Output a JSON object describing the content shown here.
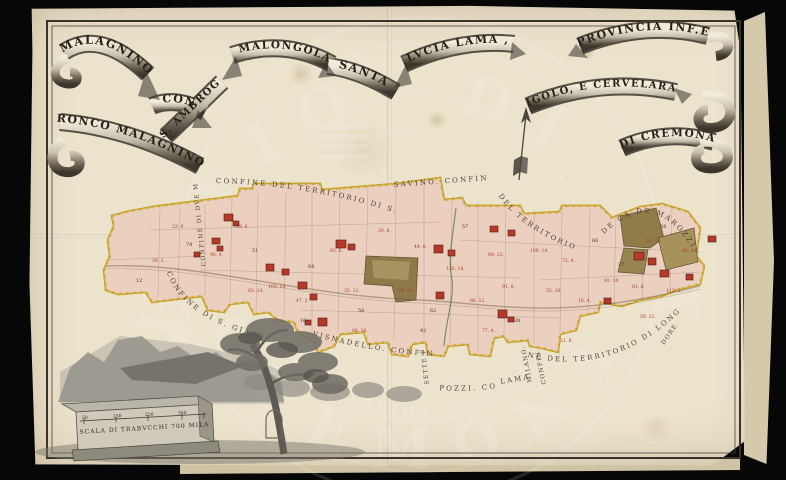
{
  "watermark": {
    "outer_top": "ARCHIVIO DI STATO",
    "outer_bottom": "CREMONA",
    "inner_ring": "REPUBBLICA ITALIANA"
  },
  "ribbon": {
    "segments": [
      "MALAGNINO",
      "CON",
      "RONCO MALAGNINO",
      "S. AMBROG.",
      ", MALONGOLA,",
      "SANTA",
      "LVCIA LAMA ,",
      "IGOLO, E CERVELARA",
      "PROVINCIA INF.E",
      "DI CREMONA"
    ]
  },
  "map_labels": {
    "confine_top_left": "CONFINE DEL TERRITORIO DI S.",
    "confine_top_mid": "SAVINO. CONFINE",
    "confine_top_right_a": "DEL TERRITORIO",
    "confine_top_right_b": "DE CÀ DE MAROZZI",
    "confine_left_vertical": "CONFINE DI DVE MIGLIA",
    "confine_left_lower": "CONFINE DI S. GIACOMO. LOVARA.",
    "confine_bottom_a": "VISNADELLO. CONFINE DE",
    "confine_bottom_vertical": "SETTE P.",
    "confine_bottom_b": "POZZI. CONF.E",
    "confine_bottom_c": "LAMA.",
    "confine_right_vertical_a": "MILANO.",
    "confine_right_vertical_b": "CONFIN.",
    "confine_bottom_right": "NE DEL TERRITORIO DI LONGAR",
    "confine_bottom_right_end": "DORE",
    "direction_e": "E."
  },
  "scale": {
    "caption": "SCALA DI TRABVCCHI 700 MILAN.",
    "ticks": [
      "50",
      "150",
      "250",
      "350"
    ]
  },
  "colors": {
    "paper": "#ece3cd",
    "ink": "#3b332a",
    "territory_fill": "#ecd0bf",
    "territory_outline": "#caa42c",
    "building_red": "#b5382a",
    "wood_olive": "#8d7a4a",
    "annotation_red": "#a63a2e"
  },
  "parcel_labels": [
    [
      172,
      228,
      "23. 8.",
      "r"
    ],
    [
      186,
      246,
      "74",
      "k"
    ],
    [
      210,
      256,
      "96. 4.",
      "r"
    ],
    [
      236,
      228,
      "29. 6.",
      "r"
    ],
    [
      252,
      252,
      "51",
      "k"
    ],
    [
      268,
      288,
      "103. 14.",
      "r"
    ],
    [
      296,
      302,
      "47. 2.",
      "r"
    ],
    [
      308,
      268,
      "64",
      "k"
    ],
    [
      330,
      252,
      "83. 6.",
      "r"
    ],
    [
      344,
      292,
      "35. 12.",
      "r"
    ],
    [
      358,
      312,
      "58",
      "k"
    ],
    [
      378,
      232,
      "29. 6.",
      "r"
    ],
    [
      398,
      292,
      "76. 18.",
      "r"
    ],
    [
      414,
      248,
      "44. 8.",
      "r"
    ],
    [
      430,
      312,
      "62",
      "k"
    ],
    [
      446,
      270,
      "120. 14.",
      "r"
    ],
    [
      462,
      228,
      "57",
      "k"
    ],
    [
      470,
      302,
      "86. 12.",
      "r"
    ],
    [
      488,
      256,
      "69. 12.",
      "r"
    ],
    [
      502,
      288,
      "91. 8.",
      "r"
    ],
    [
      514,
      322,
      "38",
      "k"
    ],
    [
      530,
      252,
      "109. 14.",
      "r"
    ],
    [
      546,
      292,
      "55. 16.",
      "r"
    ],
    [
      562,
      262,
      "72. 4.",
      "r"
    ],
    [
      578,
      302,
      "18. 4.",
      "r"
    ],
    [
      592,
      242,
      "66",
      "k"
    ],
    [
      604,
      282,
      "93. 10.",
      "r"
    ],
    [
      618,
      266,
      "27",
      "k"
    ],
    [
      632,
      288,
      "81. 6.",
      "r"
    ],
    [
      646,
      242,
      "52. 10.",
      "r"
    ],
    [
      660,
      228,
      "34",
      "k"
    ],
    [
      666,
      292,
      "113. 2.",
      "r"
    ],
    [
      682,
      252,
      "48. 14.",
      "r"
    ],
    [
      640,
      318,
      "59. 12.",
      "r"
    ],
    [
      560,
      342,
      "21. 8.",
      "r"
    ],
    [
      482,
      332,
      "77. 4.",
      "r"
    ],
    [
      420,
      332,
      "42",
      "k"
    ],
    [
      352,
      332,
      "88. 10.",
      "r"
    ],
    [
      300,
      322,
      "16",
      "k"
    ],
    [
      248,
      292,
      "65. 14.",
      "r"
    ],
    [
      152,
      262,
      "39. 2.",
      "r"
    ],
    [
      136,
      282,
      "12",
      "k"
    ]
  ],
  "buildings": [
    [
      224,
      214,
      9,
      7
    ],
    [
      233,
      221,
      6,
      5
    ],
    [
      212,
      238,
      8,
      6
    ],
    [
      217,
      246,
      6,
      5
    ],
    [
      266,
      264,
      8,
      7
    ],
    [
      282,
      269,
      7,
      6
    ],
    [
      298,
      282,
      9,
      7
    ],
    [
      310,
      294,
      7,
      6
    ],
    [
      318,
      318,
      9,
      8
    ],
    [
      336,
      240,
      10,
      8
    ],
    [
      348,
      244,
      7,
      6
    ],
    [
      434,
      245,
      9,
      8
    ],
    [
      448,
      250,
      7,
      6
    ],
    [
      436,
      292,
      8,
      7
    ],
    [
      498,
      310,
      9,
      8
    ],
    [
      508,
      317,
      6,
      5
    ],
    [
      490,
      226,
      8,
      6
    ],
    [
      508,
      230,
      7,
      6
    ],
    [
      634,
      252,
      10,
      8
    ],
    [
      648,
      258,
      8,
      7
    ],
    [
      660,
      270,
      9,
      7
    ],
    [
      686,
      274,
      7,
      6
    ],
    [
      708,
      236,
      8,
      6
    ],
    [
      604,
      298,
      7,
      6
    ],
    [
      305,
      320,
      6,
      5
    ],
    [
      194,
      252,
      6,
      5
    ]
  ]
}
